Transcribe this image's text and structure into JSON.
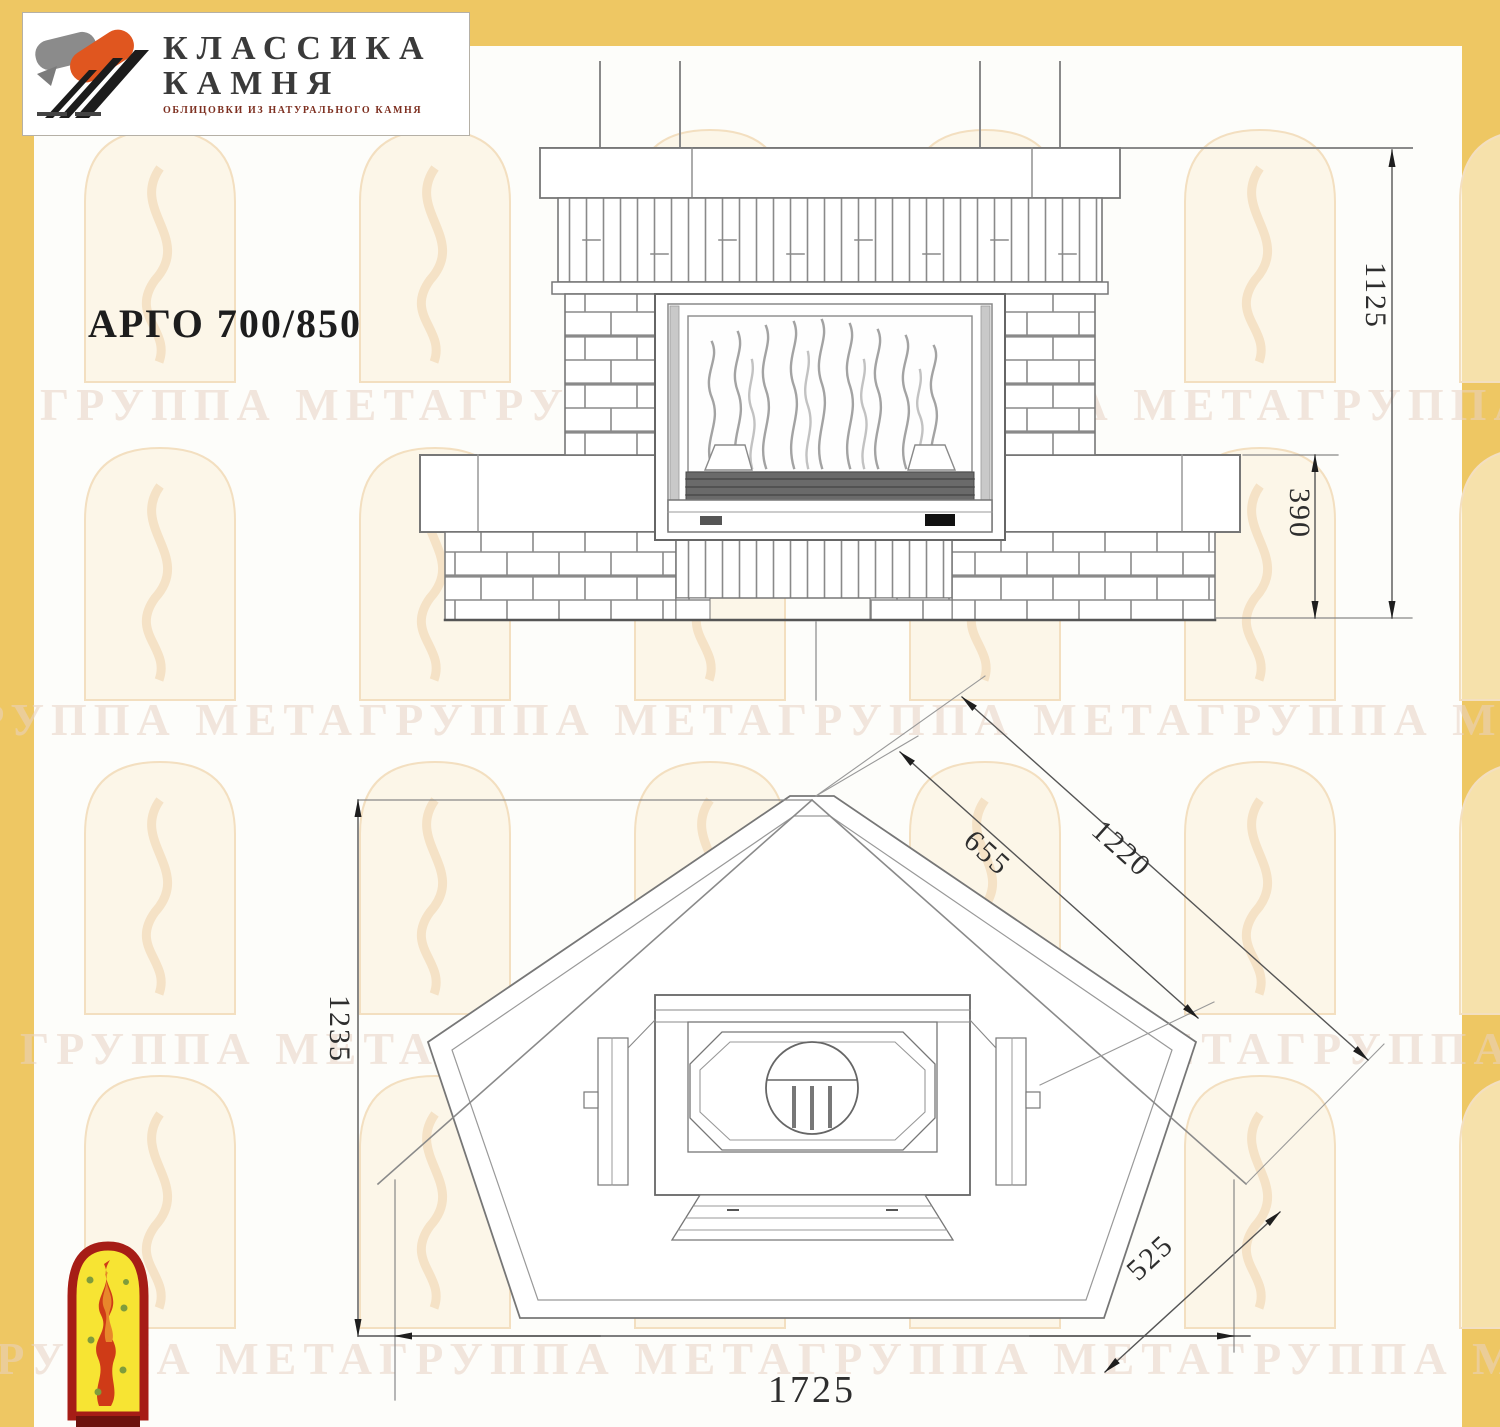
{
  "title": "АРГО 700/850",
  "logo": {
    "name_line1": "КЛАССИКА",
    "name_line2": "КАМНЯ",
    "tagline": "ОБЛИЦОВКИ ИЗ НАТУРАЛЬНОГО КАМНЯ"
  },
  "watermark": {
    "text": "ГРУППА МЕТАГРУППА МЕТАГРУППА МЕТАГРУППА МЕТА"
  },
  "dimensions": {
    "front_height_mm": "1125",
    "base_height_mm": "390",
    "firebox_width_mm": "655",
    "right_side_mm": "1220",
    "depth_mm": "1235",
    "front_corner_mm": "525",
    "total_width_mm": "1725"
  },
  "colors": {
    "accent_yellow": "#eec763",
    "logo_orange": "#e0561f",
    "arch_yellow": "#f7e433",
    "arch_border": "#a61d16",
    "flame_red": "#cf3b17",
    "line_gray": "#777777"
  }
}
